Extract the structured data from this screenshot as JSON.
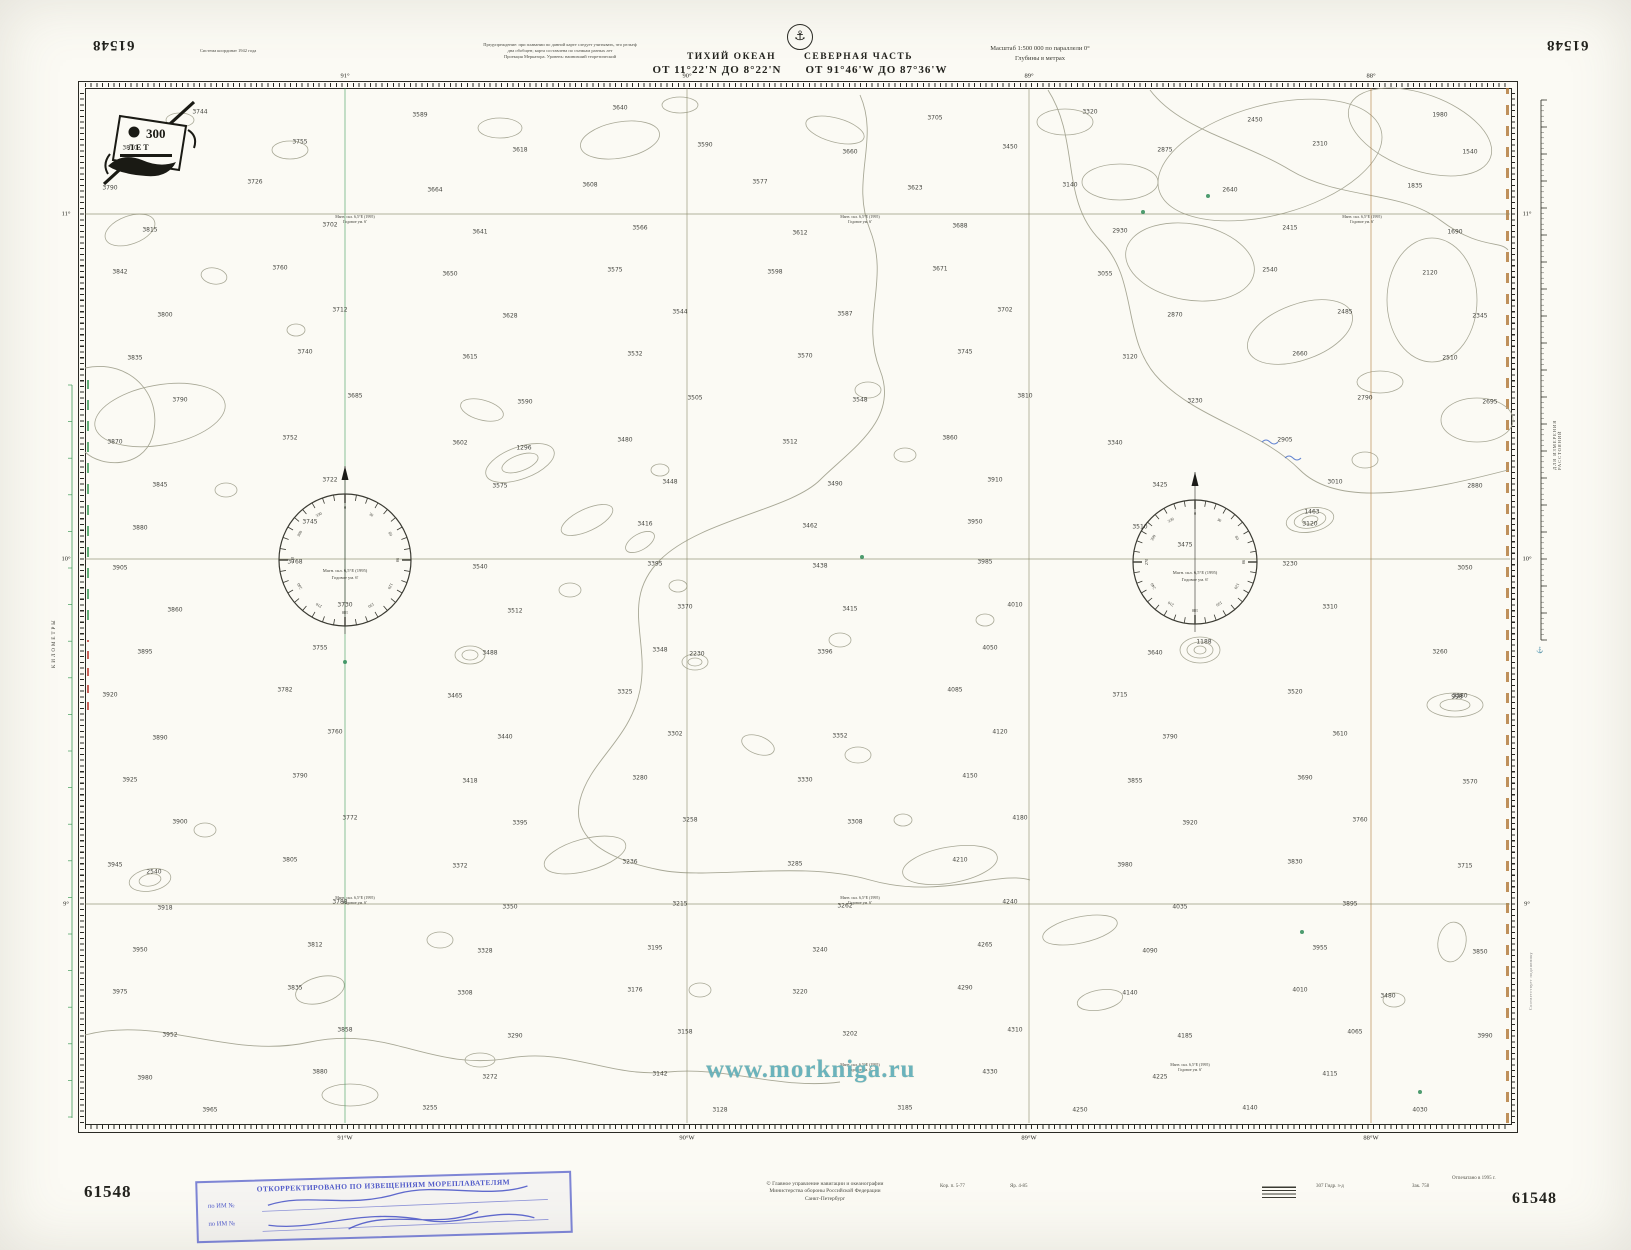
{
  "chart_number": "61548",
  "header": {
    "datum_note": "Система координат 1942 года",
    "note1": "Предупреждение: при плавании по данной карте следует учитывать, что рельеф",
    "note2": "дна обобщен; карта составлена по съемкам разных лет",
    "note3": "Проекция Меркатора. Уровень: наинизший теоретический",
    "emblem_glyph": "⚓",
    "title_part1": "ТИХИЙ ОКЕАН",
    "title_part2": "СЕВЕРНАЯ ЧАСТЬ",
    "range_lat": "ОТ 11°22'N ДО 8°22'N",
    "range_lon": "ОТ 91°46'W ДО 87°36'W",
    "scale_line1": "Масштаб 1:500 000 по параллели 0°",
    "scale_line2": "Глубины в метрах"
  },
  "emblem300": {
    "number": "300",
    "word": "ЛЕТ"
  },
  "margins": {
    "kilometry": "КИЛОМЕТРЫ",
    "ruler_caption": "ДЛЯ ИЗМЕРЕНИЯ РАССТОЯНИЙ",
    "side_note": "Соответствует подлиннику"
  },
  "graticule": {
    "lon_x": [
      345,
      687,
      1029,
      1371
    ],
    "lons_top": [
      "91°",
      "90°",
      "89°",
      "88°"
    ],
    "lons_bottom": [
      "91°W",
      "90°W",
      "89°W",
      "88°W"
    ],
    "lon_colors": [
      "#3f9b59",
      "#8a8a6a",
      "#8a8a6a",
      "#b07a3a"
    ],
    "lat_y": [
      214,
      559,
      904
    ],
    "lats": [
      "11°",
      "10°",
      "9°"
    ]
  },
  "rose": {
    "line1": "Магн. скл. 6,5°E (1995)",
    "line2": "Годовое ум. 6'",
    "positions": [
      {
        "cx": 345,
        "cy": 560,
        "r": 66
      },
      {
        "cx": 1195,
        "cy": 562,
        "r": 62
      }
    ]
  },
  "mag_note": {
    "line1": "Магн. скл. 6,5°E (1995)",
    "line2": "Годовое ум. 6'"
  },
  "mag_note_positions": [
    [
      355,
      214
    ],
    [
      860,
      214
    ],
    [
      1362,
      214
    ],
    [
      355,
      895
    ],
    [
      860,
      895
    ],
    [
      860,
      1062
    ],
    [
      1190,
      1062
    ]
  ],
  "soundings": [
    [
      200,
      112,
      3744
    ],
    [
      420,
      115,
      3589
    ],
    [
      620,
      108,
      3640
    ],
    [
      935,
      118,
      3705
    ],
    [
      1090,
      112,
      3320
    ],
    [
      1255,
      120,
      2450
    ],
    [
      1440,
      115,
      1980
    ],
    [
      130,
      148,
      3810
    ],
    [
      300,
      142,
      3755
    ],
    [
      520,
      150,
      3618
    ],
    [
      705,
      145,
      3590
    ],
    [
      850,
      152,
      3660
    ],
    [
      1010,
      147,
      3450
    ],
    [
      1165,
      150,
      2875
    ],
    [
      1320,
      144,
      2310
    ],
    [
      1470,
      152,
      1540
    ],
    [
      110,
      188,
      3790
    ],
    [
      255,
      182,
      3726
    ],
    [
      435,
      190,
      3664
    ],
    [
      590,
      185,
      3608
    ],
    [
      760,
      182,
      3577
    ],
    [
      915,
      188,
      3623
    ],
    [
      1070,
      185,
      3140
    ],
    [
      1230,
      190,
      2640
    ],
    [
      1415,
      186,
      1835
    ],
    [
      150,
      230,
      3815
    ],
    [
      330,
      225,
      3702
    ],
    [
      480,
      232,
      3641
    ],
    [
      640,
      228,
      3566
    ],
    [
      800,
      233,
      3612
    ],
    [
      960,
      226,
      3688
    ],
    [
      1120,
      231,
      2930
    ],
    [
      1290,
      228,
      2415
    ],
    [
      1455,
      232,
      1690
    ],
    [
      120,
      272,
      3842
    ],
    [
      280,
      268,
      3760
    ],
    [
      450,
      274,
      3650
    ],
    [
      615,
      270,
      3575
    ],
    [
      775,
      272,
      3598
    ],
    [
      940,
      269,
      3671
    ],
    [
      1105,
      274,
      3055
    ],
    [
      1270,
      270,
      2540
    ],
    [
      1430,
      273,
      2120
    ],
    [
      165,
      315,
      3800
    ],
    [
      340,
      310,
      3712
    ],
    [
      510,
      316,
      3628
    ],
    [
      680,
      312,
      3544
    ],
    [
      845,
      314,
      3587
    ],
    [
      1005,
      310,
      3702
    ],
    [
      1175,
      315,
      2870
    ],
    [
      1345,
      312,
      2485
    ],
    [
      1480,
      316,
      2345
    ],
    [
      135,
      358,
      3835
    ],
    [
      305,
      352,
      3740
    ],
    [
      470,
      357,
      3615
    ],
    [
      635,
      354,
      3532
    ],
    [
      805,
      356,
      3570
    ],
    [
      965,
      352,
      3745
    ],
    [
      1130,
      357,
      3120
    ],
    [
      1300,
      354,
      2660
    ],
    [
      1450,
      358,
      2510
    ],
    [
      180,
      400,
      3790
    ],
    [
      355,
      396,
      3685
    ],
    [
      525,
      402,
      3590
    ],
    [
      695,
      398,
      3505
    ],
    [
      860,
      400,
      3548
    ],
    [
      1025,
      396,
      3810
    ],
    [
      1195,
      401,
      3230
    ],
    [
      1365,
      398,
      2790
    ],
    [
      1490,
      402,
      2695
    ],
    [
      115,
      442,
      3870
    ],
    [
      290,
      438,
      3752
    ],
    [
      460,
      443,
      3602
    ],
    [
      625,
      440,
      3480
    ],
    [
      790,
      442,
      3512
    ],
    [
      950,
      438,
      3860
    ],
    [
      1115,
      443,
      3340
    ],
    [
      1285,
      440,
      2905
    ],
    [
      160,
      485,
      3845
    ],
    [
      330,
      480,
      3722
    ],
    [
      500,
      486,
      3575
    ],
    [
      670,
      482,
      3448
    ],
    [
      835,
      484,
      3490
    ],
    [
      995,
      480,
      3910
    ],
    [
      1160,
      485,
      3425
    ],
    [
      1335,
      482,
      3010
    ],
    [
      1475,
      486,
      2880
    ],
    [
      140,
      528,
      3880
    ],
    [
      310,
      522,
      3745
    ],
    [
      645,
      524,
      3416
    ],
    [
      810,
      526,
      3462
    ],
    [
      975,
      522,
      3950
    ],
    [
      1140,
      527,
      3510
    ],
    [
      1310,
      524,
      3120
    ],
    [
      120,
      568,
      3905
    ],
    [
      295,
      562,
      3768
    ],
    [
      480,
      567,
      3540
    ],
    [
      655,
      564,
      3395
    ],
    [
      820,
      566,
      3438
    ],
    [
      985,
      562,
      3985
    ],
    [
      1185,
      545,
      3475
    ],
    [
      1290,
      564,
      3230
    ],
    [
      1465,
      568,
      3050
    ],
    [
      175,
      610,
      3860
    ],
    [
      345,
      605,
      3730
    ],
    [
      515,
      611,
      3512
    ],
    [
      685,
      607,
      3370
    ],
    [
      850,
      609,
      3415
    ],
    [
      1015,
      605,
      4010
    ],
    [
      1330,
      607,
      3310
    ],
    [
      145,
      652,
      3895
    ],
    [
      320,
      648,
      3755
    ],
    [
      490,
      653,
      3488
    ],
    [
      660,
      650,
      3348
    ],
    [
      825,
      652,
      3396
    ],
    [
      990,
      648,
      4050
    ],
    [
      1155,
      653,
      3640
    ],
    [
      1440,
      652,
      3260
    ],
    [
      110,
      695,
      3920
    ],
    [
      285,
      690,
      3782
    ],
    [
      455,
      696,
      3465
    ],
    [
      625,
      692,
      3325
    ],
    [
      955,
      690,
      4085
    ],
    [
      1120,
      695,
      3715
    ],
    [
      1295,
      692,
      3520
    ],
    [
      1460,
      696,
      3380
    ],
    [
      160,
      738,
      3890
    ],
    [
      335,
      732,
      3760
    ],
    [
      505,
      737,
      3440
    ],
    [
      675,
      734,
      3302
    ],
    [
      840,
      736,
      3352
    ],
    [
      1000,
      732,
      4120
    ],
    [
      1170,
      737,
      3790
    ],
    [
      1340,
      734,
      3610
    ],
    [
      130,
      780,
      3925
    ],
    [
      300,
      776,
      3790
    ],
    [
      470,
      781,
      3418
    ],
    [
      640,
      778,
      3280
    ],
    [
      805,
      780,
      3330
    ],
    [
      970,
      776,
      4150
    ],
    [
      1135,
      781,
      3855
    ],
    [
      1305,
      778,
      3690
    ],
    [
      1470,
      782,
      3570
    ],
    [
      180,
      822,
      3900
    ],
    [
      350,
      818,
      3772
    ],
    [
      520,
      823,
      3395
    ],
    [
      690,
      820,
      3258
    ],
    [
      855,
      822,
      3308
    ],
    [
      1020,
      818,
      4180
    ],
    [
      1190,
      823,
      3920
    ],
    [
      1360,
      820,
      3760
    ],
    [
      115,
      865,
      3945
    ],
    [
      290,
      860,
      3805
    ],
    [
      460,
      866,
      3372
    ],
    [
      630,
      862,
      3236
    ],
    [
      795,
      864,
      3285
    ],
    [
      960,
      860,
      4210
    ],
    [
      1125,
      865,
      3980
    ],
    [
      1295,
      862,
      3830
    ],
    [
      1465,
      866,
      3715
    ],
    [
      165,
      908,
      3918
    ],
    [
      340,
      902,
      3788
    ],
    [
      510,
      907,
      3350
    ],
    [
      680,
      904,
      3215
    ],
    [
      845,
      906,
      3262
    ],
    [
      1010,
      902,
      4240
    ],
    [
      1180,
      907,
      4035
    ],
    [
      1350,
      904,
      3895
    ],
    [
      140,
      950,
      3950
    ],
    [
      315,
      945,
      3812
    ],
    [
      485,
      951,
      3328
    ],
    [
      655,
      948,
      3195
    ],
    [
      820,
      950,
      3240
    ],
    [
      985,
      945,
      4265
    ],
    [
      1150,
      951,
      4090
    ],
    [
      1320,
      948,
      3955
    ],
    [
      1480,
      952,
      3850
    ],
    [
      120,
      992,
      3975
    ],
    [
      295,
      988,
      3835
    ],
    [
      465,
      993,
      3308
    ],
    [
      635,
      990,
      3176
    ],
    [
      800,
      992,
      3220
    ],
    [
      965,
      988,
      4290
    ],
    [
      1130,
      993,
      4140
    ],
    [
      1300,
      990,
      4010
    ],
    [
      170,
      1035,
      3952
    ],
    [
      345,
      1030,
      3858
    ],
    [
      515,
      1036,
      3290
    ],
    [
      685,
      1032,
      3158
    ],
    [
      850,
      1034,
      3202
    ],
    [
      1015,
      1030,
      4310
    ],
    [
      1185,
      1036,
      4185
    ],
    [
      1355,
      1032,
      4065
    ],
    [
      1485,
      1036,
      3990
    ],
    [
      145,
      1078,
      3980
    ],
    [
      320,
      1072,
      3880
    ],
    [
      490,
      1077,
      3272
    ],
    [
      660,
      1074,
      3142
    ],
    [
      990,
      1072,
      4330
    ],
    [
      1160,
      1077,
      4225
    ],
    [
      1330,
      1074,
      4115
    ],
    [
      210,
      1110,
      3965
    ],
    [
      430,
      1108,
      3255
    ],
    [
      720,
      1110,
      3128
    ],
    [
      905,
      1108,
      3185
    ],
    [
      1080,
      1110,
      4250
    ],
    [
      1250,
      1108,
      4140
    ],
    [
      1420,
      1110,
      4030
    ],
    [
      524,
      448,
      1296
    ],
    [
      1312,
      512,
      1463
    ],
    [
      1204,
      642,
      1188
    ],
    [
      697,
      654,
      2230
    ],
    [
      1457,
      697,
      998
    ],
    [
      154,
      872,
      2540
    ],
    [
      1388,
      996,
      3480
    ]
  ],
  "blobs": [
    [
      130,
      230,
      26,
      14,
      -20
    ],
    [
      214,
      276,
      13,
      8,
      10
    ],
    [
      160,
      415,
      66,
      30,
      -10
    ],
    [
      296,
      330,
      9,
      6,
      0
    ],
    [
      226,
      490,
      11,
      7,
      0
    ],
    [
      482,
      410,
      22,
      10,
      15
    ],
    [
      520,
      463,
      36,
      16,
      -20
    ],
    [
      520,
      463,
      19,
      8,
      -20
    ],
    [
      587,
      520,
      28,
      11,
      -25
    ],
    [
      640,
      542,
      16,
      8,
      -30
    ],
    [
      470,
      655,
      15,
      9,
      0
    ],
    [
      470,
      655,
      8,
      5,
      0
    ],
    [
      570,
      590,
      11,
      7,
      0
    ],
    [
      678,
      586,
      9,
      6,
      0
    ],
    [
      695,
      662,
      13,
      8,
      0
    ],
    [
      695,
      662,
      7,
      4,
      0
    ],
    [
      868,
      390,
      13,
      8,
      0
    ],
    [
      905,
      455,
      11,
      7,
      0
    ],
    [
      660,
      470,
      9,
      6,
      0
    ],
    [
      758,
      745,
      17,
      9,
      20
    ],
    [
      858,
      755,
      13,
      8,
      0
    ],
    [
      903,
      820,
      9,
      6,
      0
    ],
    [
      150,
      880,
      21,
      11,
      -10
    ],
    [
      150,
      880,
      11,
      6,
      -10
    ],
    [
      205,
      830,
      11,
      7,
      0
    ],
    [
      320,
      990,
      25,
      13,
      -15
    ],
    [
      440,
      940,
      13,
      8,
      0
    ],
    [
      700,
      990,
      11,
      7,
      0
    ],
    [
      1100,
      1000,
      23,
      10,
      -10
    ],
    [
      1394,
      1000,
      11,
      7,
      0
    ],
    [
      1452,
      942,
      14,
      20,
      10
    ],
    [
      1270,
      160,
      115,
      55,
      -15
    ],
    [
      1420,
      132,
      75,
      38,
      20
    ],
    [
      1190,
      262,
      65,
      38,
      10
    ],
    [
      1300,
      332,
      55,
      28,
      -20
    ],
    [
      1432,
      300,
      45,
      62,
      0
    ],
    [
      1120,
      182,
      38,
      18,
      0
    ],
    [
      1065,
      122,
      28,
      13,
      0
    ],
    [
      1477,
      420,
      36,
      22,
      0
    ],
    [
      1380,
      382,
      23,
      11,
      0
    ],
    [
      1310,
      520,
      24,
      12,
      -10
    ],
    [
      1310,
      520,
      16,
      8,
      -10
    ],
    [
      1310,
      520,
      8,
      4,
      -10
    ],
    [
      1200,
      650,
      20,
      13,
      0
    ],
    [
      1200,
      650,
      13,
      8,
      0
    ],
    [
      1200,
      650,
      6,
      4,
      0
    ],
    [
      1365,
      460,
      13,
      8,
      0
    ],
    [
      1455,
      705,
      28,
      12,
      0
    ],
    [
      1455,
      705,
      15,
      6,
      0
    ],
    [
      585,
      855,
      42,
      16,
      -15
    ],
    [
      950,
      865,
      48,
      18,
      -10
    ],
    [
      1080,
      930,
      38,
      13,
      -12
    ],
    [
      350,
      1095,
      28,
      11,
      0
    ],
    [
      480,
      1060,
      15,
      7,
      0
    ],
    [
      840,
      640,
      11,
      7,
      0
    ],
    [
      985,
      620,
      9,
      6,
      0
    ],
    [
      620,
      140,
      40,
      18,
      -10
    ],
    [
      500,
      128,
      22,
      10,
      0
    ],
    [
      835,
      130,
      30,
      12,
      15
    ],
    [
      680,
      105,
      18,
      8,
      0
    ],
    [
      290,
      150,
      18,
      9,
      0
    ],
    [
      180,
      120,
      14,
      7,
      0
    ]
  ],
  "green_marks": [
    [
      1143,
      212
    ],
    [
      1208,
      196
    ],
    [
      1302,
      932
    ],
    [
      345,
      662
    ],
    [
      1420,
      1092
    ],
    [
      862,
      557
    ]
  ],
  "blue_marks": [
    [
      1262,
      442
    ],
    [
      1285,
      458
    ]
  ],
  "watermark": "www.morkniga.ru",
  "stamp": {
    "title": "ОТКОРРЕКТИРОВАНО ПО ИЗВЕЩЕНИЯМ МОРЕПЛАВАТЕЛЯМ",
    "row1_label": "по ИМ №",
    "row2_label": "по ИМ №"
  },
  "footer": {
    "center1": "© Главное управление навигации и океанографии",
    "center2": "Министерства обороны Российской Федерации",
    "center3": "Санкт-Петербург",
    "tiny1": "Кор. п. 5-77",
    "tiny2": "Яр. 4-85",
    "tiny3": "307 Гидр. з-д",
    "tiny4": "Зак. 758",
    "tiny5": "Отпечатано в 1995 г."
  }
}
